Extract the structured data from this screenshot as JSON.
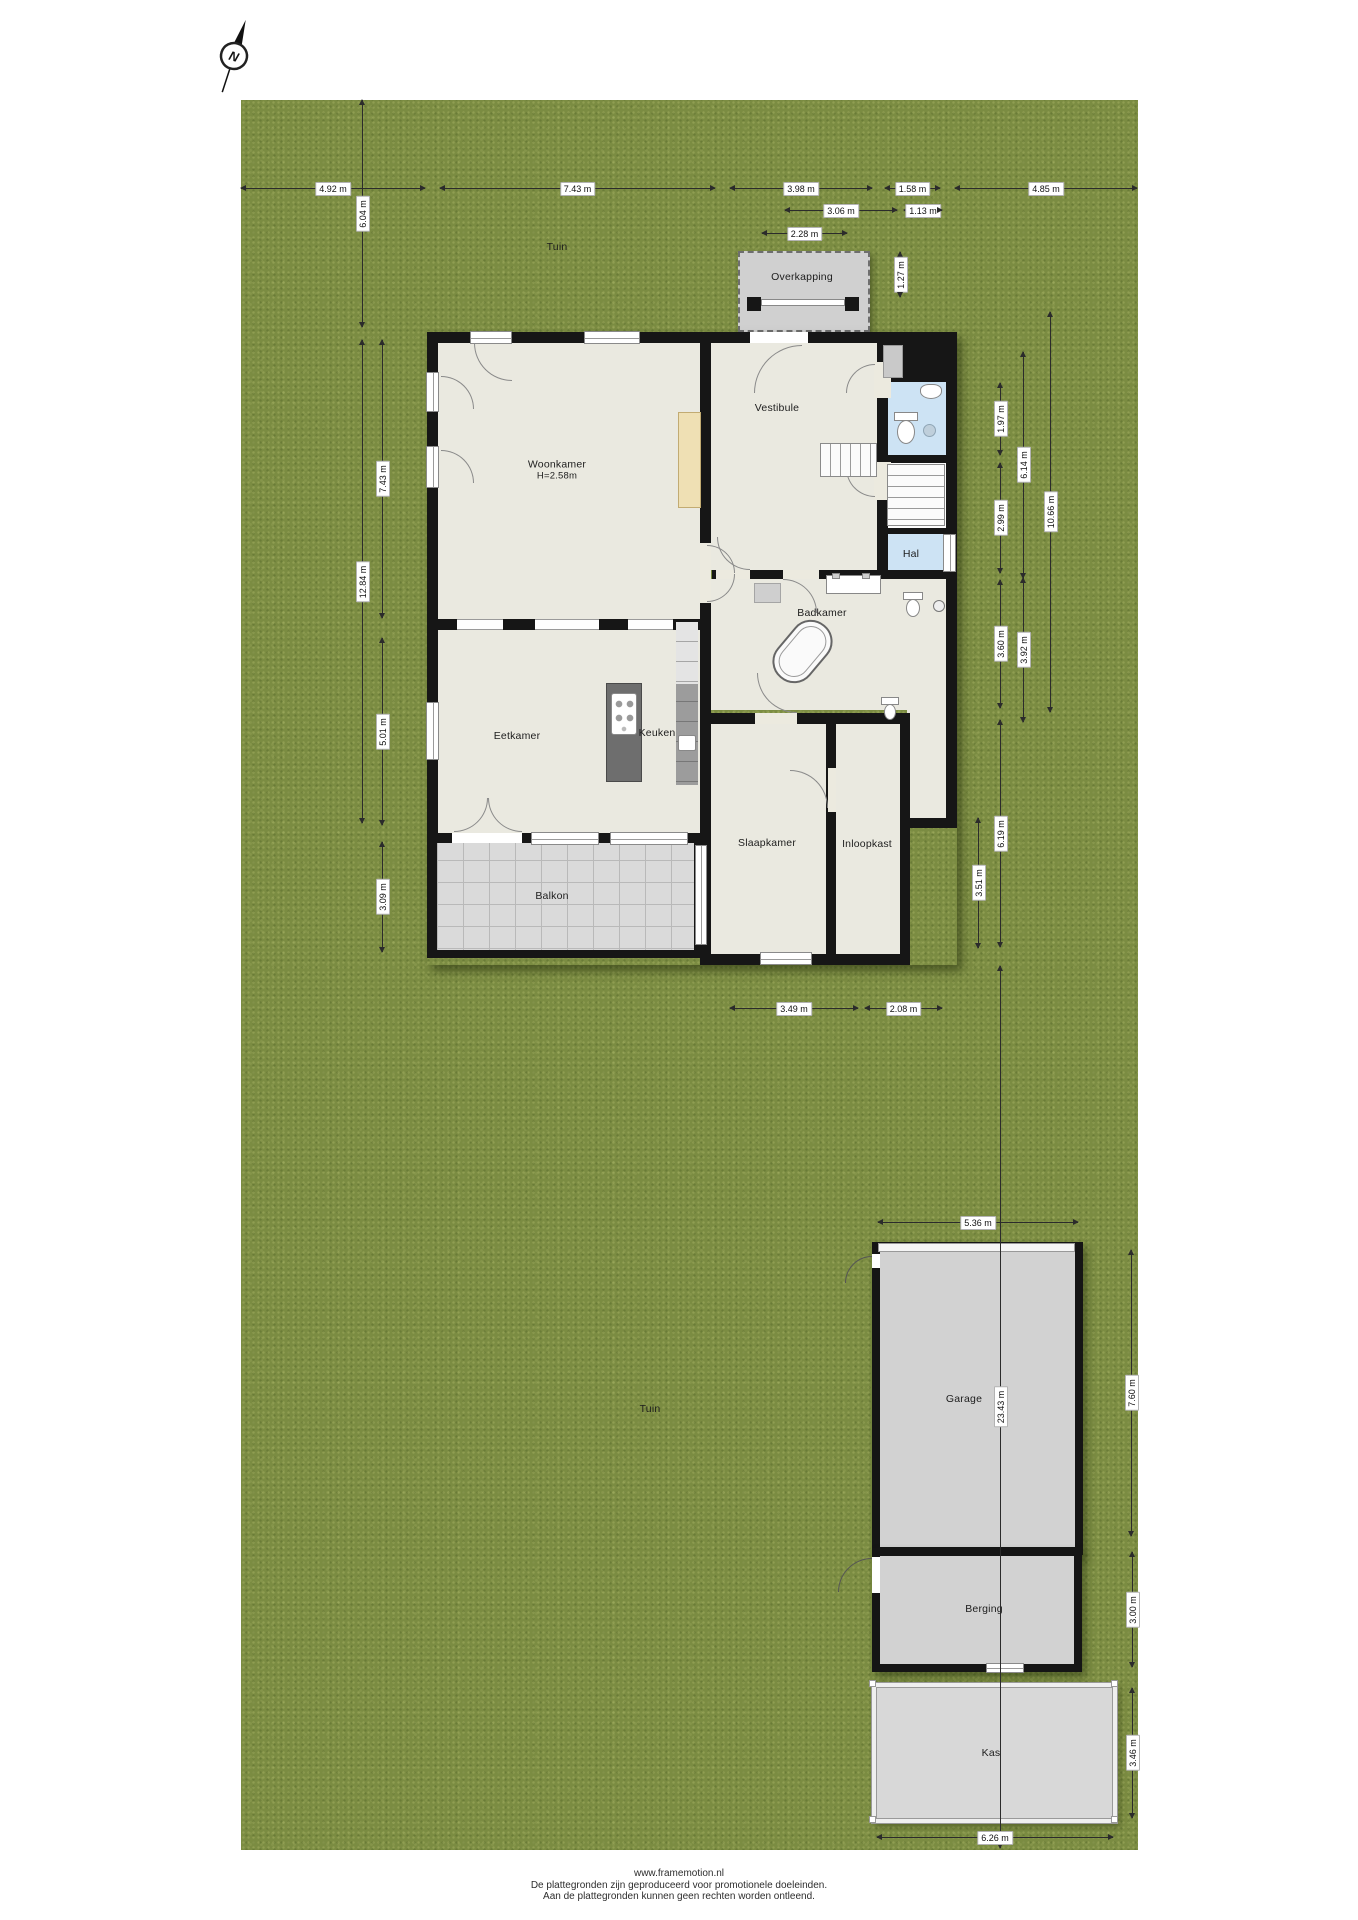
{
  "site": {
    "compass_letter": "N"
  },
  "garden_labels": [
    {
      "name": "tuin-top",
      "text": "Tuin",
      "x": 557,
      "y": 247
    },
    {
      "name": "tuin-bottom",
      "text": "Tuin",
      "x": 650,
      "y": 1409
    }
  ],
  "room_labels": [
    {
      "name": "overkapping",
      "text": "Overkapping",
      "x": 802,
      "y": 277
    },
    {
      "name": "woonkamer",
      "text": "Woonkamer",
      "sub": "H=2.58m",
      "x": 557,
      "y": 470
    },
    {
      "name": "vestibule",
      "text": "Vestibule",
      "x": 777,
      "y": 408
    },
    {
      "name": "hal",
      "text": "Hal",
      "x": 911,
      "y": 554
    },
    {
      "name": "badkamer",
      "text": "Badkamer",
      "x": 822,
      "y": 613
    },
    {
      "name": "eetkamer",
      "text": "Eetkamer",
      "x": 517,
      "y": 736
    },
    {
      "name": "keuken",
      "text": "Keuken",
      "x": 657,
      "y": 733
    },
    {
      "name": "balkon",
      "text": "Balkon",
      "x": 552,
      "y": 896
    },
    {
      "name": "slaapkamer",
      "text": "Slaapkamer",
      "x": 767,
      "y": 843
    },
    {
      "name": "inloopkast",
      "text": "Inloopkast",
      "x": 867,
      "y": 844
    },
    {
      "name": "garage",
      "text": "Garage",
      "x": 964,
      "y": 1399
    },
    {
      "name": "berging",
      "text": "Berging",
      "x": 984,
      "y": 1609
    },
    {
      "name": "kas",
      "text": "Kas",
      "x": 991,
      "y": 1753
    }
  ],
  "dimensions": [
    {
      "text": "4.92 m",
      "o": "h",
      "at": 188,
      "from": 241,
      "to": 425
    },
    {
      "text": "7.43 m",
      "o": "h",
      "at": 188,
      "from": 440,
      "to": 715
    },
    {
      "text": "3.98 m",
      "o": "h",
      "at": 188,
      "from": 730,
      "to": 872
    },
    {
      "text": "1.58 m",
      "o": "h",
      "at": 188,
      "from": 885,
      "to": 940
    },
    {
      "text": "4.85 m",
      "o": "h",
      "at": 188,
      "from": 955,
      "to": 1137
    },
    {
      "text": "3.06 m",
      "o": "h",
      "at": 210,
      "from": 785,
      "to": 897
    },
    {
      "text": "1.13 m",
      "o": "h",
      "at": 210,
      "from": 904,
      "to": 942
    },
    {
      "text": "2.28 m",
      "o": "h",
      "at": 233,
      "from": 762,
      "to": 847
    },
    {
      "text": "1.27 m",
      "o": "v",
      "at": 900,
      "from": 252,
      "to": 297
    },
    {
      "text": "6.04 m",
      "o": "v",
      "at": 362,
      "from": 100,
      "to": 327
    },
    {
      "text": "12.84 m",
      "o": "v",
      "at": 362,
      "from": 340,
      "to": 823
    },
    {
      "text": "7.43 m",
      "o": "v",
      "at": 382,
      "from": 340,
      "to": 618
    },
    {
      "text": "5.01 m",
      "o": "v",
      "at": 382,
      "from": 638,
      "to": 825
    },
    {
      "text": "3.09 m",
      "o": "v",
      "at": 382,
      "from": 842,
      "to": 952
    },
    {
      "text": "1.97 m",
      "o": "v",
      "at": 1000,
      "from": 383,
      "to": 455
    },
    {
      "text": "2.99 m",
      "o": "v",
      "at": 1000,
      "from": 463,
      "to": 573
    },
    {
      "text": "3.60 m",
      "o": "v",
      "at": 1000,
      "from": 580,
      "to": 708
    },
    {
      "text": "6.19 m",
      "o": "v",
      "at": 1000,
      "from": 720,
      "to": 947
    },
    {
      "text": "6.14 m",
      "o": "v",
      "at": 1023,
      "from": 352,
      "to": 578
    },
    {
      "text": "3.92 m",
      "o": "v",
      "at": 1023,
      "from": 578,
      "to": 722
    },
    {
      "text": "10.66 m",
      "o": "v",
      "at": 1050,
      "from": 312,
      "to": 712
    },
    {
      "text": "3.51 m",
      "o": "v",
      "at": 978,
      "from": 818,
      "to": 948
    },
    {
      "text": "3.49 m",
      "o": "h",
      "at": 1008,
      "from": 730,
      "to": 858
    },
    {
      "text": "2.08 m",
      "o": "h",
      "at": 1008,
      "from": 865,
      "to": 942
    },
    {
      "text": "5.36 m",
      "o": "h",
      "at": 1222,
      "from": 878,
      "to": 1078
    },
    {
      "text": "23.43 m",
      "o": "v",
      "at": 1000,
      "from": 966,
      "to": 1848
    },
    {
      "text": "7.60 m",
      "o": "v",
      "at": 1131,
      "from": 1250,
      "to": 1536
    },
    {
      "text": "3.00 m",
      "o": "v",
      "at": 1132,
      "from": 1552,
      "to": 1667
    },
    {
      "text": "3.46 m",
      "o": "v",
      "at": 1132,
      "from": 1688,
      "to": 1818
    },
    {
      "text": "6.26 m",
      "o": "h",
      "at": 1837,
      "from": 877,
      "to": 1113
    }
  ],
  "footer": {
    "lines": [
      "www.framemotion.nl",
      "De plattegronden zijn geproduceerd voor promotionele doeleinden.",
      "Aan de plattegronden kunnen geen rechten worden ontleend."
    ]
  }
}
